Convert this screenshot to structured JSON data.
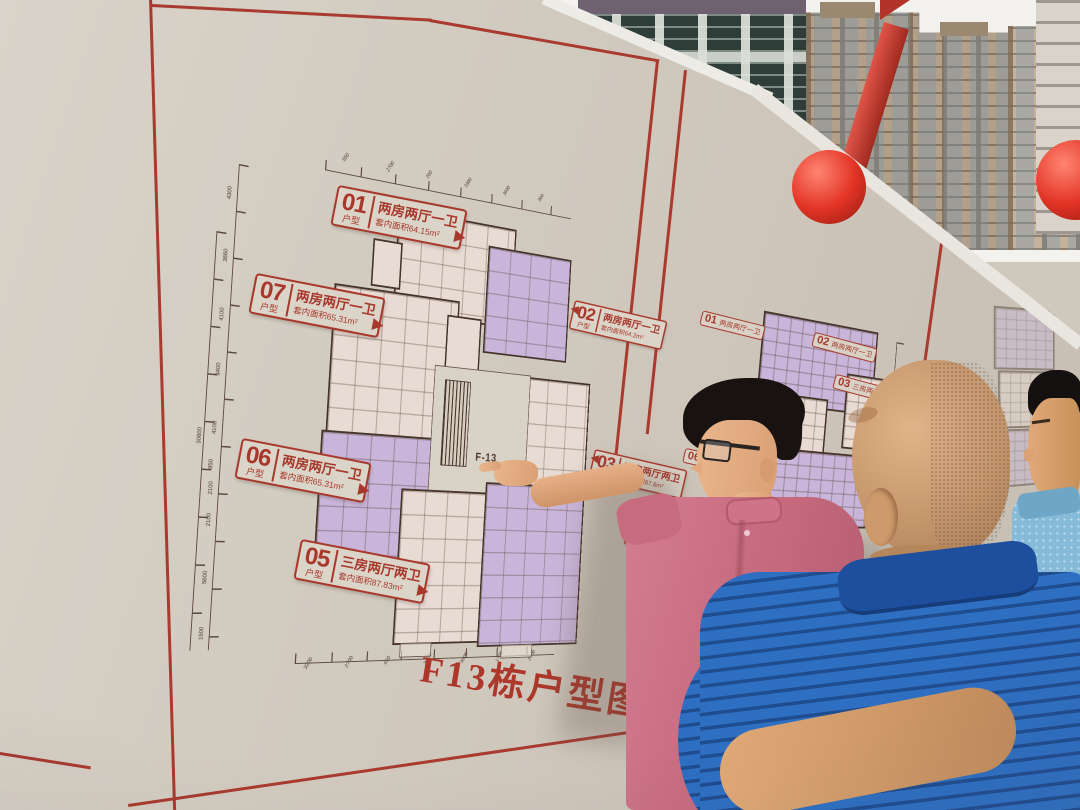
{
  "board": {
    "title": "F13栋户型图",
    "note": "注：1．三房五期户型图",
    "core_label": "F-13"
  },
  "poster1": {
    "units": [
      {
        "num": "01",
        "kind": "户型",
        "title": "两房两厅一卫",
        "area": "套内面积64.15m²"
      },
      {
        "num": "07",
        "kind": "户型",
        "title": "两房两厅一卫",
        "area": "套内面积65.31m²"
      },
      {
        "num": "06",
        "kind": "户型",
        "title": "两房两厅一卫",
        "area": "套内面积65.31m²"
      },
      {
        "num": "05",
        "kind": "户型",
        "title": "三房两厅两卫",
        "area": "套内面积87.83m²"
      },
      {
        "num": "02",
        "kind": "户型",
        "title": "两房两厅一卫",
        "area": "套内面积64.2m²"
      },
      {
        "num": "03",
        "kind": "户型",
        "title": "三房两厅两卫",
        "area": "套内面积87.8m²"
      },
      {
        "num": "04",
        "kind": "户型",
        "title": "",
        "area": ""
      }
    ],
    "dims_left": [
      "4300",
      "3660",
      "4100",
      "3400",
      "4100",
      "850",
      "2100",
      "2100",
      "5600",
      "1500"
    ],
    "dims_left_total": "30600",
    "dims_top": [
      "850",
      "2700",
      "200",
      "3300",
      "3600",
      "900"
    ],
    "dims_bottom": [
      "3200",
      "2700",
      "450",
      "3400",
      "3600",
      "1700",
      "2700"
    ]
  },
  "poster2": {
    "labels": [
      {
        "num": "01",
        "text": "两房两厅一卫"
      },
      {
        "num": "02",
        "text": "两房两厅一卫"
      },
      {
        "num": "03",
        "text": "三房两厅两卫"
      },
      {
        "num": "06",
        "text": "三房两厅两卫"
      }
    ]
  },
  "colors": {
    "accent_red": "#a93a2f",
    "board": "#cfc8bd",
    "lavender_unit": "#c9b5d9",
    "pink_unit": "#e8dbd3",
    "plan_wall": "#46342b",
    "shirt_pink": "#c96d80",
    "shirt_blue": "#2e6fc2",
    "shirt_lightblue": "#85bad8",
    "balloon_red": "#e23426"
  }
}
